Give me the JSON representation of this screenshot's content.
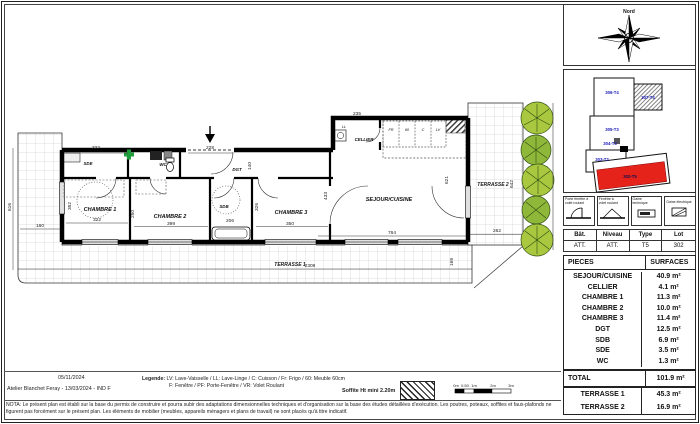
{
  "meta": {
    "print_date": "05/11/2024",
    "firm_line": "Atelier Blanchet Feray - 13/03/2024 - IND F",
    "legend_title": "Legende:",
    "legend_line1": "LV: Lave-Vaisselle / LL: Lave-Linge / C: Cuisson / Fr: Frigo / 60: Meuble 60cm",
    "legend_line2": "F: Fenêtre / PF: Porte-Fenêtre / VR: Volet Roulant",
    "soffite_note": "Soffite Ht mini 2.20m",
    "scale_labels": [
      "0m",
      "0.50",
      "1m",
      "2m",
      "3m"
    ],
    "nota_line1": "NOTA: Le présent plan est établi sur la base du permis de construire et pourra subir des adaptations dimensionnelles techniques et d'organisation sur la base des études détaillées d'exécution. Les poutres, poteaux, soffites et faux-plafonds ne",
    "nota_line2": "figurent pas forcément sur le présent plan. Les éléments de mobilier (meubles, appareils ménagers et plans de travail) ne sont placés qu'à titre indicatif."
  },
  "compass": {
    "north_label": "Nord"
  },
  "key_plan": {
    "units": {
      "u306": "306-T4",
      "u307": "307-T4",
      "u305": "305-T3",
      "u304": "304-T3",
      "u303": "303-T2",
      "u302": "302-T5"
    }
  },
  "legend_boxes": [
    {
      "line1": "Porte fenêtre à",
      "line2": "volet roulant"
    },
    {
      "line1": "Fenêtre à",
      "line2": "volet roulant"
    },
    {
      "line1": "Gaine",
      "line2": "technique"
    },
    {
      "line1": "Gaine électrique",
      "line2": ""
    }
  ],
  "lot_info": {
    "headers": [
      "Bât.",
      "Niveau",
      "Type",
      "Lot"
    ],
    "values": [
      "ATT.",
      "ATT.",
      "T5",
      "302"
    ]
  },
  "surfaces": {
    "header": [
      "PIECES",
      "SURFACES"
    ],
    "rows": [
      [
        "SEJOUR/CUISINE",
        "40.9 m²"
      ],
      [
        "CELLIER",
        "4.1 m²"
      ],
      [
        "CHAMBRE 1",
        "11.3 m²"
      ],
      [
        "CHAMBRE 2",
        "10.0 m²"
      ],
      [
        "CHAMBRE 3",
        "11.4 m²"
      ],
      [
        "DGT",
        "12.5 m²"
      ],
      [
        "SDB",
        "6.9 m²"
      ],
      [
        "SDE",
        "3.5 m²"
      ],
      [
        "WC",
        "1.3 m²"
      ]
    ],
    "total": [
      "TOTAL",
      "101.9 m²"
    ],
    "terrasses": [
      [
        "TERRASSE 1",
        "45.3 m²"
      ],
      [
        "TERRASSE 2",
        "16.9 m²"
      ]
    ]
  },
  "plan": {
    "rooms": {
      "sde": "SDE",
      "wc": "WC",
      "dgt": "DGT",
      "chambre1": "CHAMBRE 1",
      "chambre2": "CHAMBRE 2",
      "sdb": "SDB",
      "chambre3": "CHAMBRE 3",
      "sejour": "SEJOUR/CUISINE",
      "cellier": "CELLIER",
      "terrasse1": "TERRASSE 1",
      "terrasse2": "TERRASSE 2"
    },
    "appliances": {
      "ll": "LL",
      "fr": "FR",
      "m60": "60",
      "c": "C",
      "lv": "LV"
    },
    "dims": {
      "top_322": "322",
      "top_228": "228",
      "top_140": "140",
      "cellier_235": "235",
      "left_616": "616",
      "left_160": "160",
      "ch1_352": "352",
      "ch1_322": "322",
      "mid_250": "250",
      "ch2_399": "399",
      "sdb_206": "206",
      "ch3_326": "326",
      "ch3_350": "350",
      "dgt_433": "433",
      "sejour_764": "764",
      "sejour_621": "621",
      "t2_642": "642",
      "t2_262": "262",
      "t1_2309": "2309",
      "t1_169": "169"
    }
  },
  "colors": {
    "highlight_unit_red": "#e5231b",
    "keyplan_label_blue": "#1a1ab8",
    "plant_green": "#a9c83f",
    "plant_dark_green": "#2f4d12",
    "gaine_green": "#1e9e3a"
  }
}
